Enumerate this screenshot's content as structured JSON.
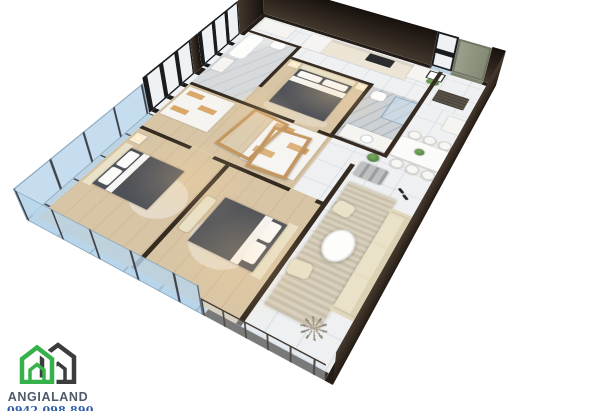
{
  "page": {
    "background": "#ffffff",
    "subject": "3D isometric rendering of an apartment floor plan"
  },
  "watermark": {
    "brand": "ANGIALAND",
    "phone": "0942.098.890",
    "brand_color": "#4e5a68",
    "phone_color": "#2f5fa9",
    "logo": {
      "green_house_color": "#35b24a",
      "dark_house_color": "#3b3d3f"
    }
  },
  "palette": {
    "exterior_wall": "#241c16",
    "interior_wall": "#352b21",
    "wood_floor": "#d8c5a5",
    "tile_floor": "#eef0f1",
    "bathroom_marble": "#d7dadc",
    "glass_wall_blue": "#bcd3e4",
    "sofa_cream": "#ebe3c8",
    "rug_beige": "#d5cdbb",
    "oak_accent": "#c4975f",
    "blanket_charcoal": "#4e5158",
    "entrance_door_olive": "#959a86",
    "plant_green": "#5a8f4f"
  },
  "floorplan": {
    "view": "isometric-3d",
    "rooms": [
      "kitchen",
      "entrance-hall",
      "bathroom-1",
      "bathroom-2",
      "master-bedroom",
      "wardrobe-hall",
      "bedroom-2",
      "bedroom-3",
      "dining-area",
      "living-room",
      "balcony"
    ],
    "furniture": [
      "kitchen-counter",
      "fridge",
      "cooktop",
      "corner-cabinet",
      "entrance-door",
      "doormat",
      "wall-art",
      "potted-plant",
      "bathtub",
      "wash-basin",
      "toilet",
      "shower-enclosure",
      "double-bed",
      "nightstand",
      "table-lamp",
      "wardrobe",
      "oak-door-frame",
      "round-rug",
      "dining-table",
      "dining-chairs",
      "sofa",
      "gray-bench",
      "coffee-table",
      "pouf",
      "striped-rug",
      "slippers",
      "ceiling-fan",
      "balcony-railing",
      "glass-wall",
      "window"
    ]
  }
}
